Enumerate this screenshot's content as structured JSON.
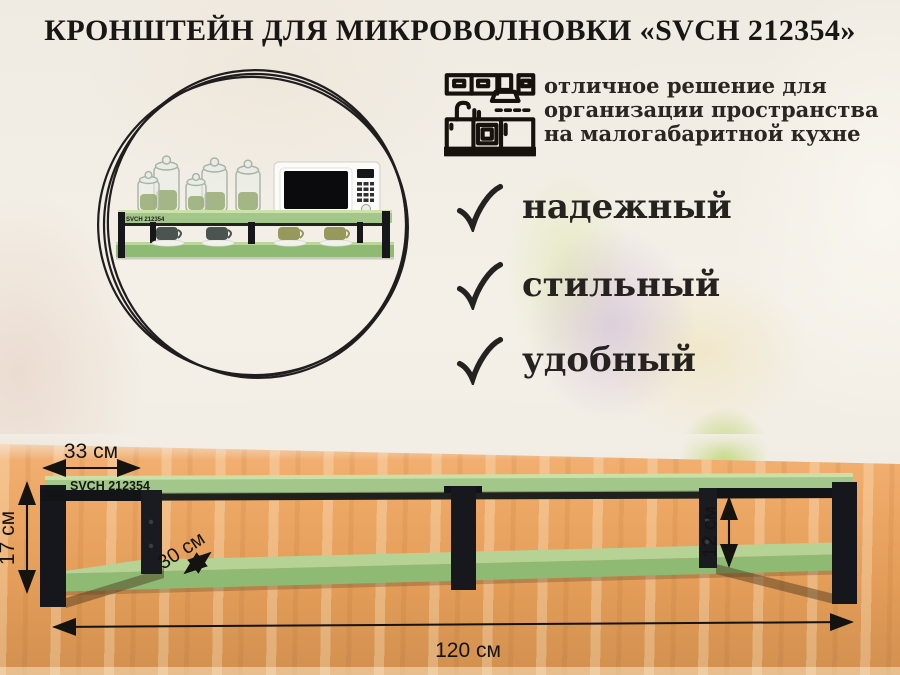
{
  "title": "КРОНШТЕЙН ДЛЯ МИКРОВОЛНОВКИ «SVCH 212354»",
  "product_code": "SVCH 212354",
  "intro": {
    "icon": "kitchen-line-art",
    "lines": [
      "отличное решение для",
      "организации пространства",
      "на малогабаритной кухне"
    ]
  },
  "features": [
    {
      "icon": "check",
      "label": "надежный"
    },
    {
      "icon": "check",
      "label": "стильный"
    },
    {
      "icon": "check",
      "label": "удобный"
    }
  ],
  "dimensions": {
    "bracket_depth_top": "33 см",
    "total_height": "17 см",
    "shelf_depth": "30 см",
    "inner_height": "12 см",
    "total_width": "120 см"
  },
  "colors": {
    "shelf_green": "#a3c78a",
    "shelf_green_light": "#cbe0a9",
    "bracket_black": "#17181d",
    "wood_brown": "#eca865",
    "text_black": "#1b1916",
    "background_cream": "#f2eee6"
  }
}
